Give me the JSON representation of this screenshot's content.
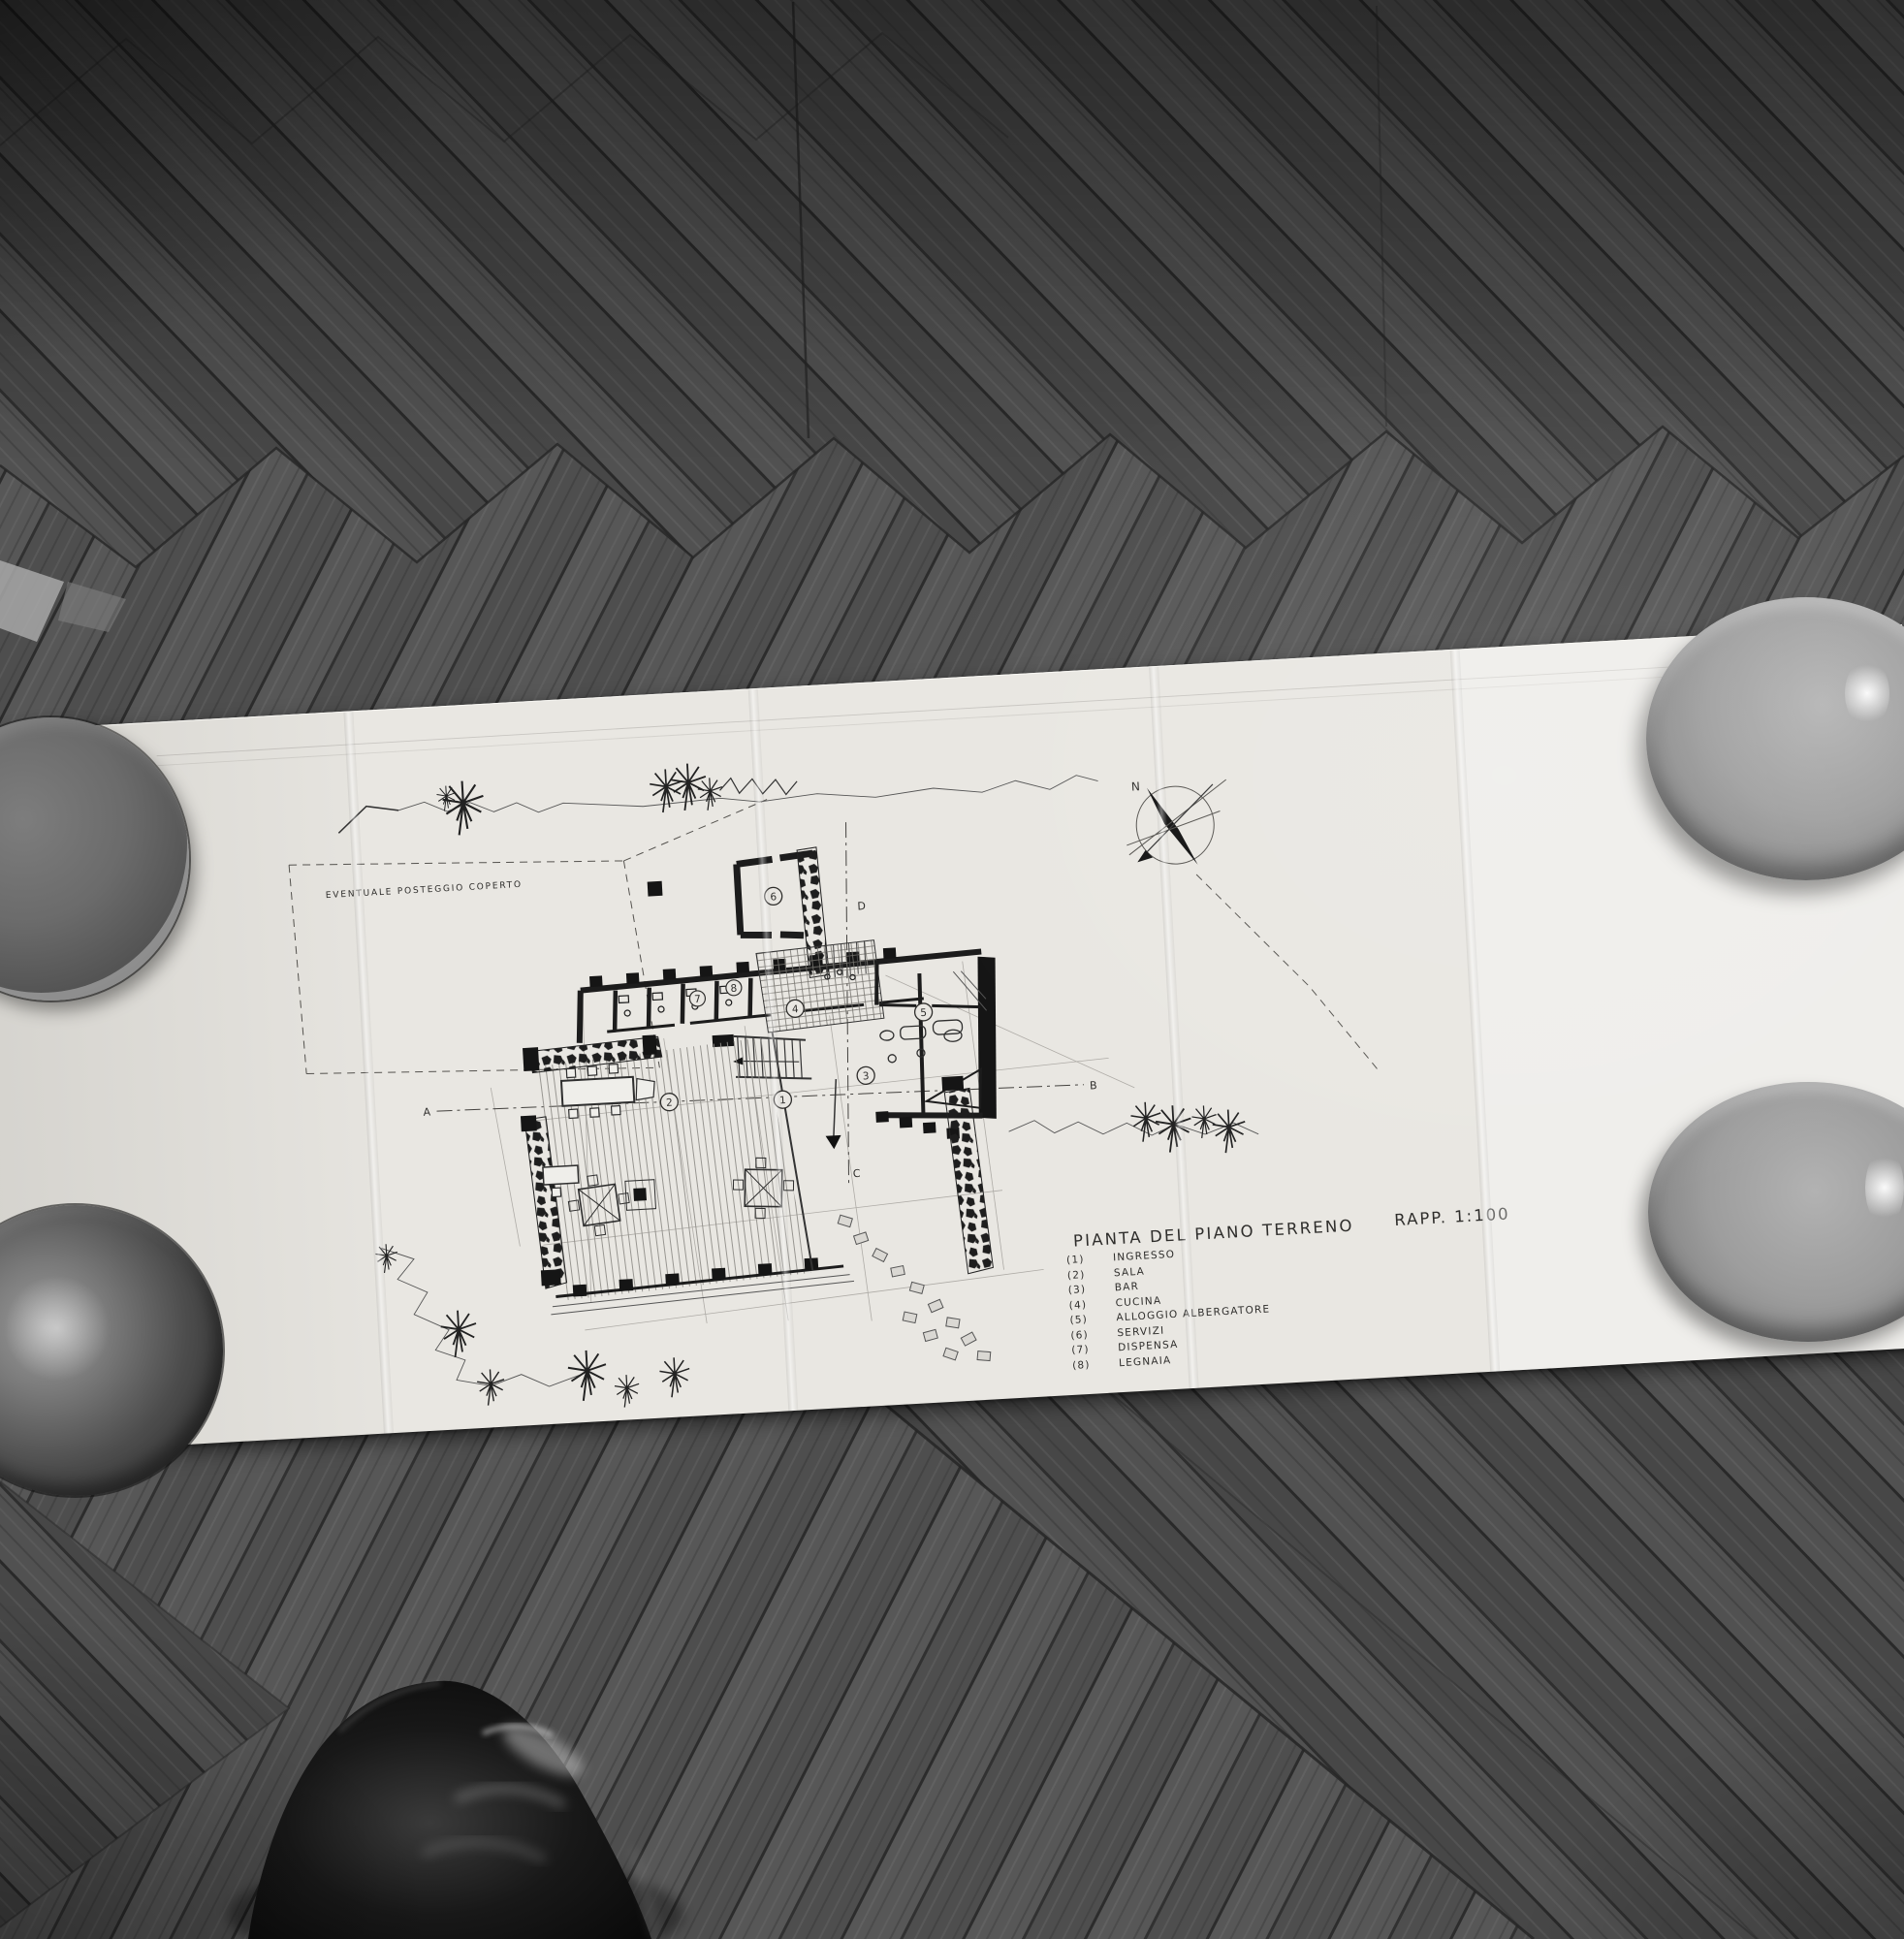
{
  "colors": {
    "floor_base": "#505050",
    "floor_seam": "#2c2c2c",
    "paper": "#e9e7e2",
    "ink": "#1c1c1c",
    "pencil": "#9b9893",
    "bowl_dark": "#4f4f4f",
    "bowl_light": "#9e9e9e",
    "shoe": "#0f0f0f"
  },
  "drawing": {
    "title": "PIANTA DEL PIANO TERRENO",
    "scale_label": "RAPP. 1:100",
    "note_parking": "EVENTUALE POSTEGGIO COPERTO",
    "compass_north_label": "N",
    "sections": {
      "a": "A",
      "b": "B",
      "c": "C",
      "d": "D"
    },
    "room_numbers": [
      "1",
      "2",
      "3",
      "4",
      "5",
      "6",
      "7",
      "8"
    ],
    "legend": {
      "items": [
        {
          "num": "(1)",
          "label": "INGRESSO"
        },
        {
          "num": "(2)",
          "label": "SALA"
        },
        {
          "num": "(3)",
          "label": "BAR"
        },
        {
          "num": "(4)",
          "label": "CUCINA"
        },
        {
          "num": "(5)",
          "label": "ALLOGGIO ALBERGATORE"
        },
        {
          "num": "(6)",
          "label": "SERVIZI"
        },
        {
          "num": "(7)",
          "label": "DISPENSA"
        },
        {
          "num": "(8)",
          "label": "LEGNAIA"
        }
      ]
    }
  }
}
